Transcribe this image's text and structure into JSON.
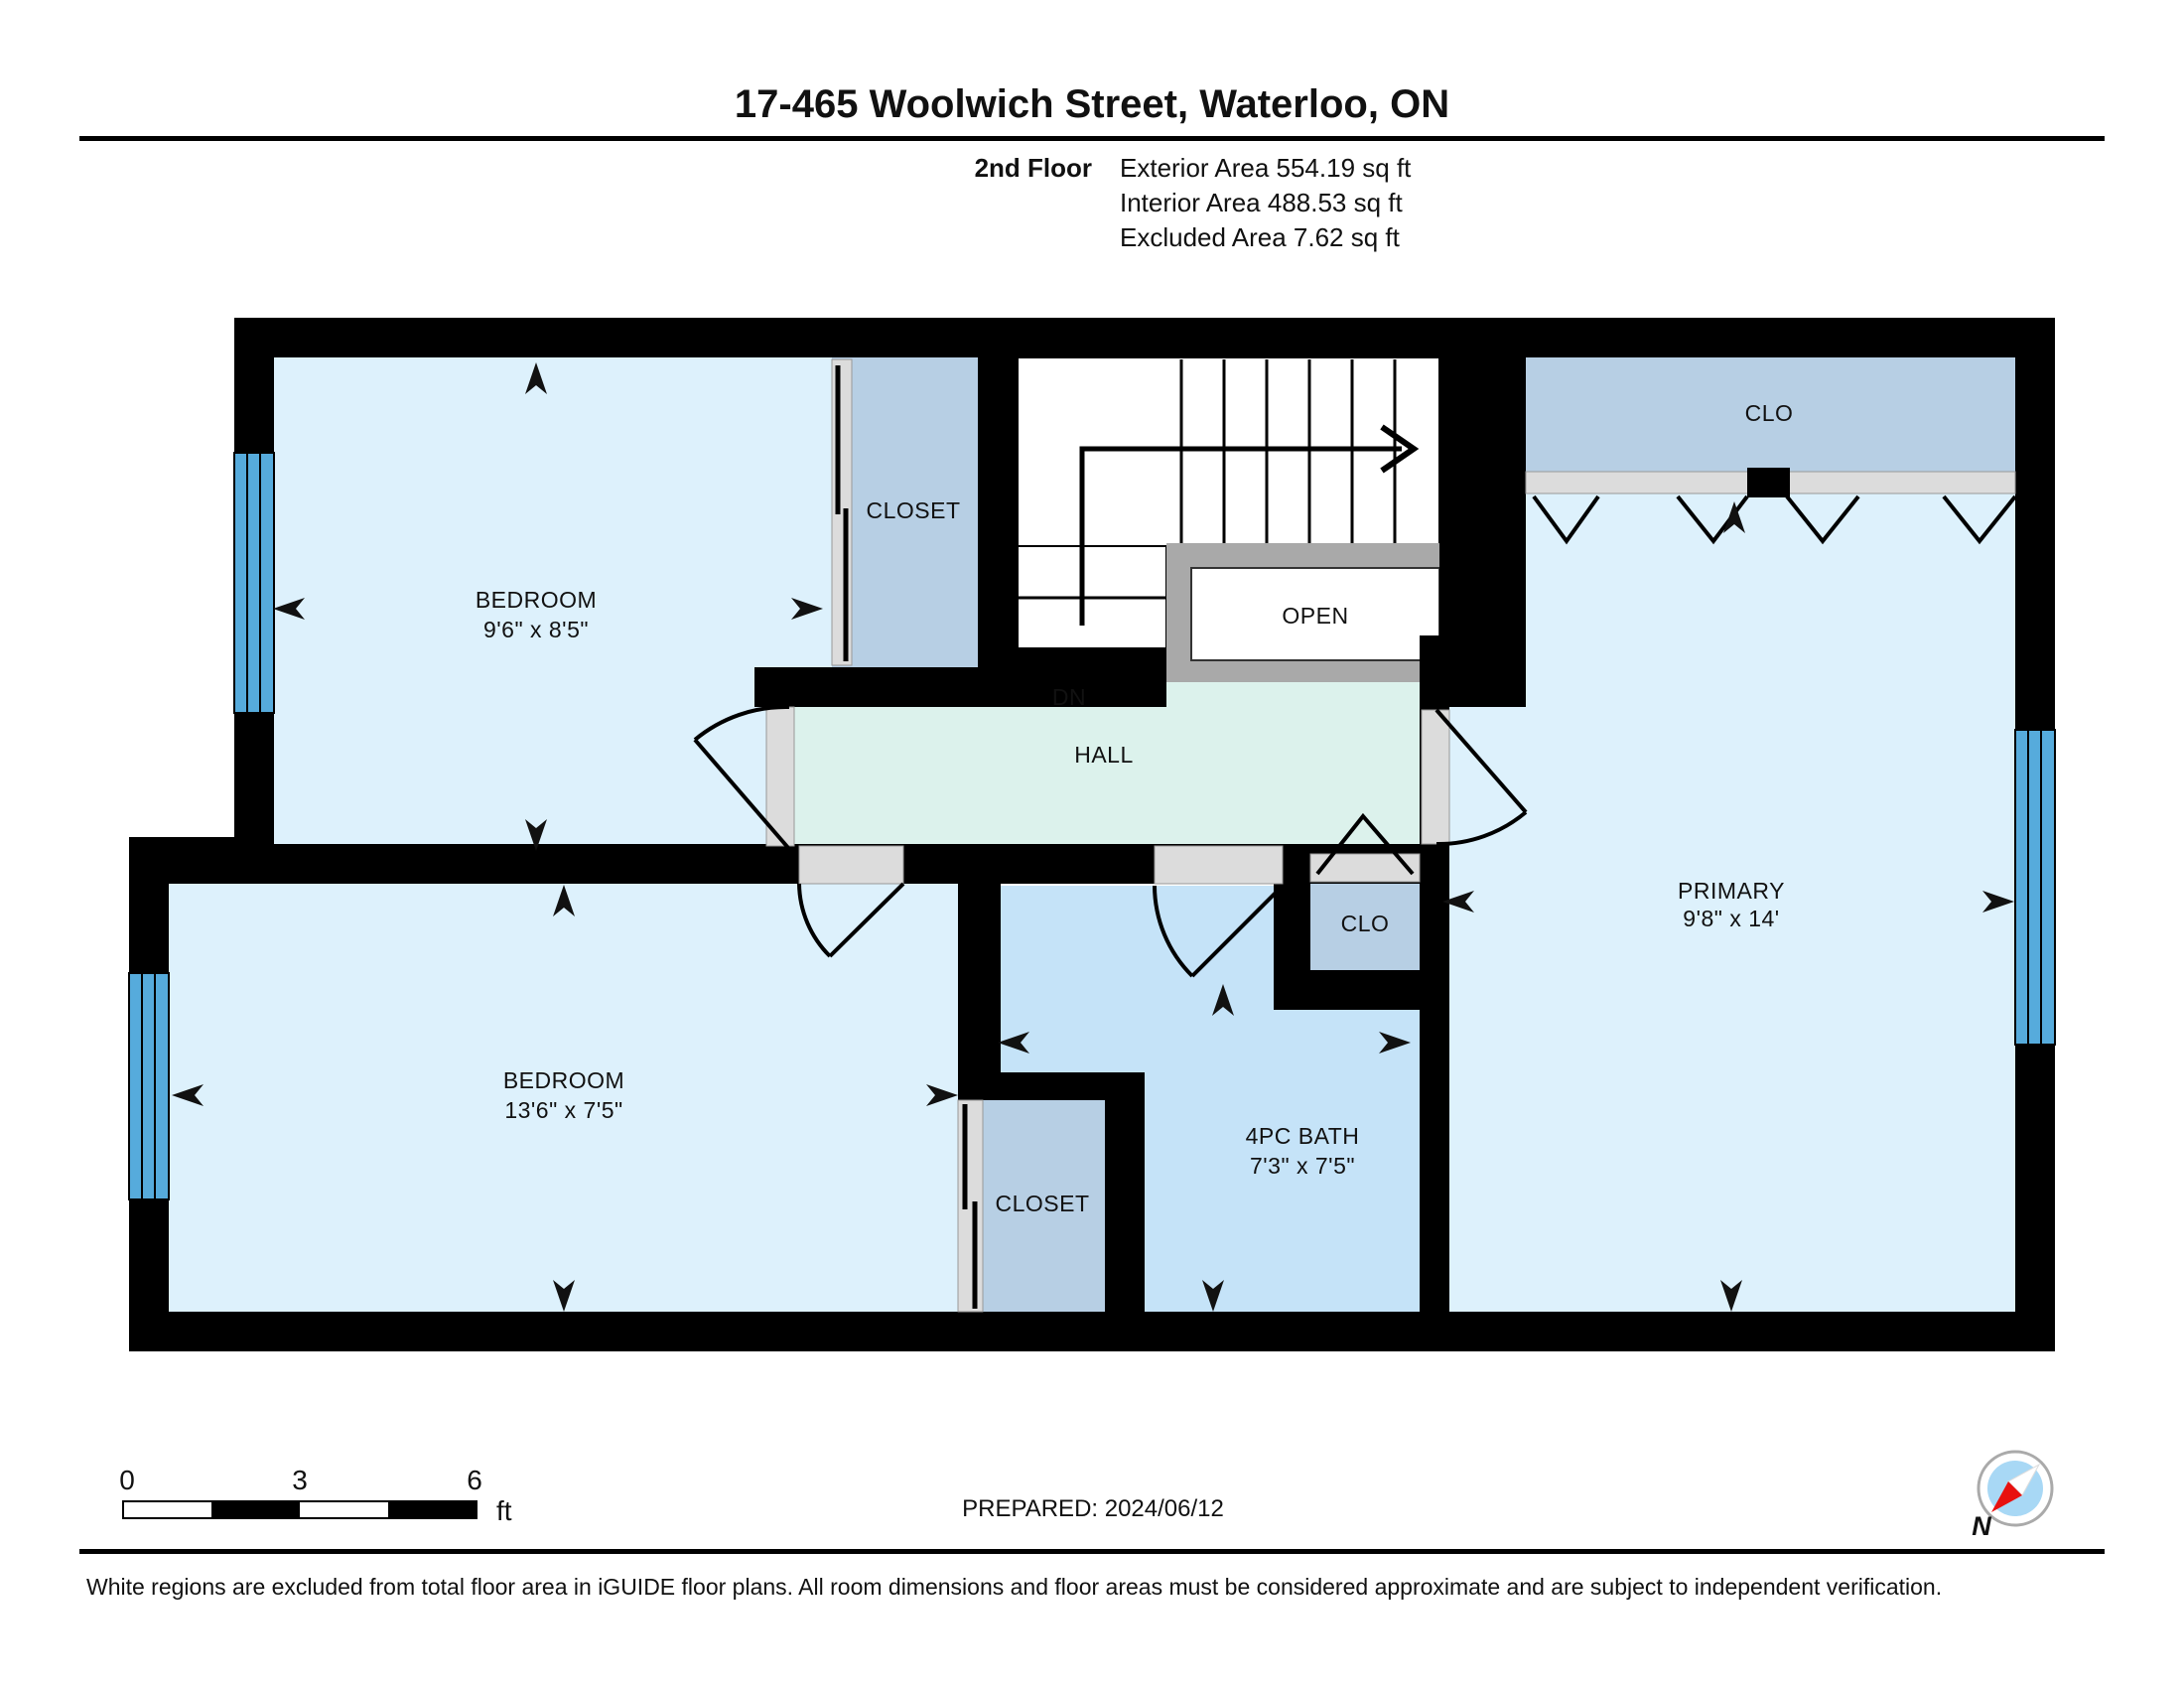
{
  "header": {
    "title": "17-465 Woolwich Street, Waterloo, ON",
    "floor_label": "2nd Floor",
    "exterior_area": "Exterior Area 554.19 sq ft",
    "interior_area": "Interior Area 488.53 sq ft",
    "excluded_area": "Excluded Area 7.62 sq ft"
  },
  "rooms": {
    "bedroom1": {
      "name": "BEDROOM",
      "dims": "9'6\" x 8'5\""
    },
    "bedroom2": {
      "name": "BEDROOM",
      "dims": "13'6\" x 7'5\""
    },
    "primary": {
      "name": "PRIMARY",
      "dims": "9'8\" x 14'"
    },
    "bath": {
      "name": "4PC BATH",
      "dims": "7'3\" x 7'5\""
    },
    "closet_top": {
      "name": "CLOSET"
    },
    "closet_bottom": {
      "name": "CLOSET"
    },
    "clo_top_right": {
      "name": "CLO"
    },
    "clo_small": {
      "name": "CLO"
    },
    "hall": {
      "name": "HALL"
    },
    "down_label": "DN",
    "open_label": "OPEN"
  },
  "scale_bar": {
    "tick0": "0",
    "tick3": "3",
    "tick6": "6",
    "unit": "ft"
  },
  "footer": {
    "prepared": "PREPARED: 2024/06/12",
    "disclaimer": "White regions are excluded from total floor area in iGUIDE floor plans. All room dimensions and floor areas must be considered approximate and are subject to independent verification."
  },
  "compass": {
    "north_label": "N"
  },
  "colors": {
    "wall": "#000000",
    "room": "#ddf1fc",
    "bath": "#c5e3f8",
    "closet": "#b7cfe4",
    "hall": "#dcf2ec",
    "stairs": "#e3e3e3",
    "open_frame": "#a9a9a9",
    "open_inner": "#ffffff",
    "door_opening": "#dcdcdc",
    "window": "#56abdc",
    "compass_inner": "#a8d8f5",
    "compass_needle": "#e8110f"
  }
}
